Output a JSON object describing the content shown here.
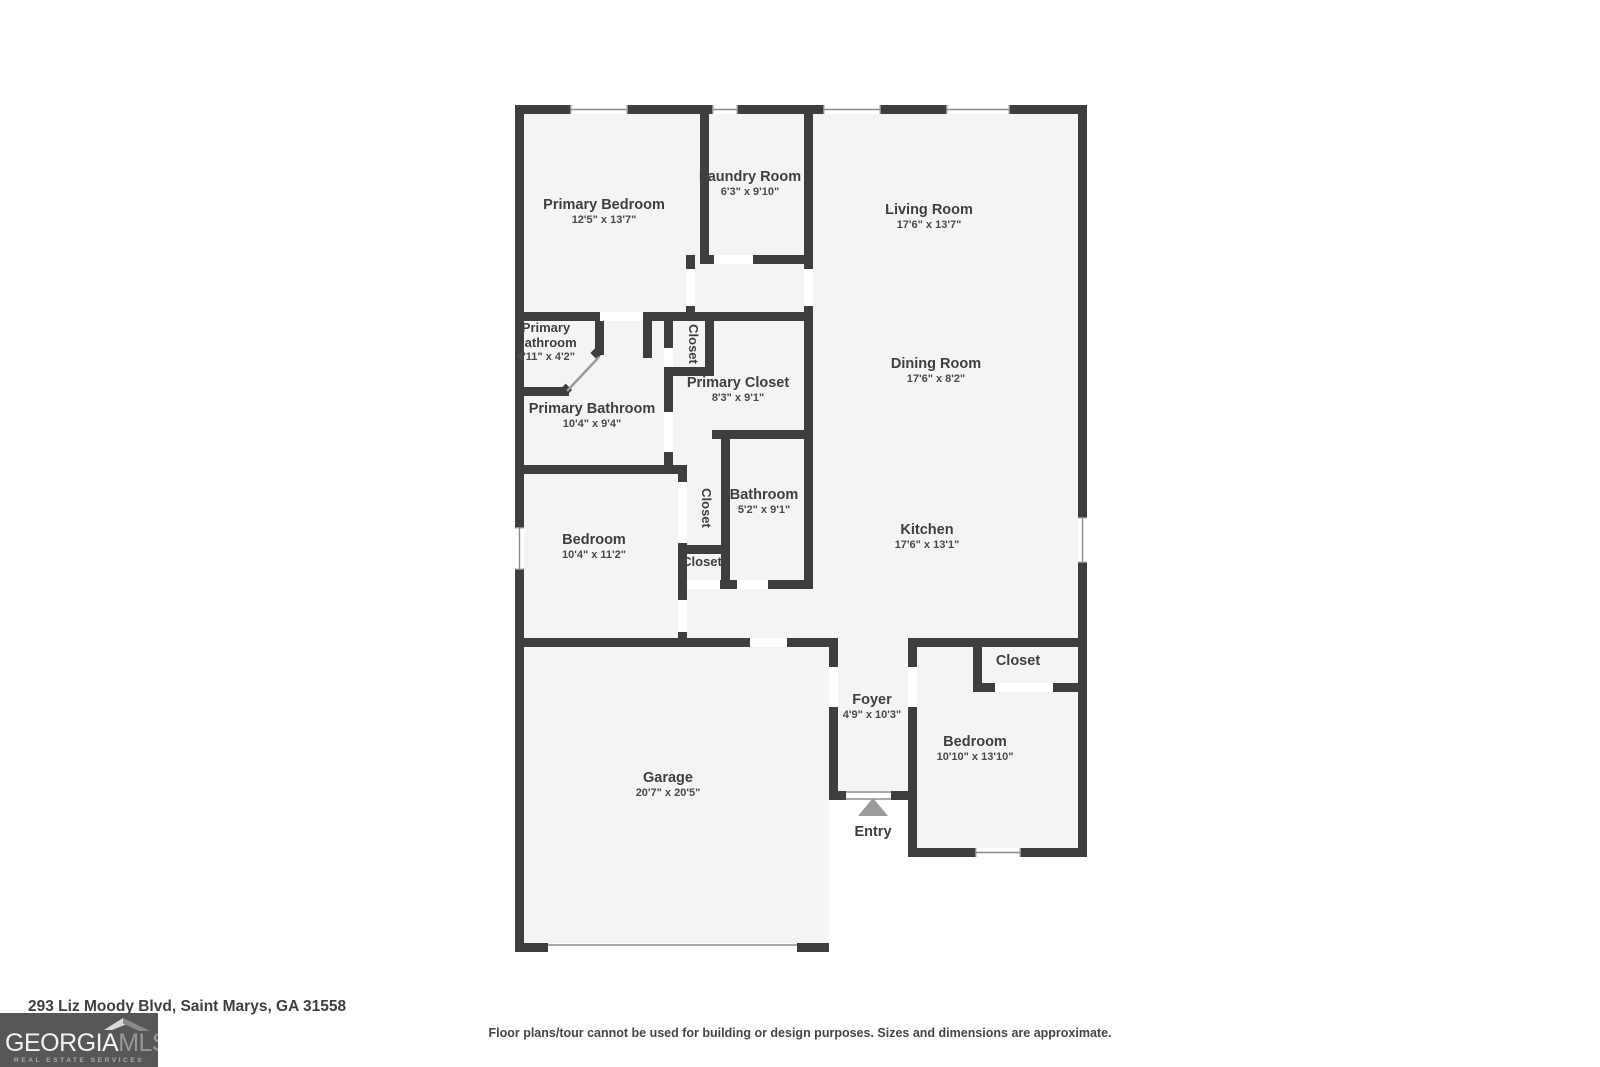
{
  "colors": {
    "wall": "#3e3e40",
    "floor": "#f4f4f4",
    "label": "#3f3f41",
    "logo_background": "#57575a",
    "logo_accent": "#97979a"
  },
  "plan": {
    "entry_label": "Entry",
    "rooms": {
      "primary_bedroom": {
        "name": "Primary Bedroom",
        "dims": "12'5\" x 13'7\""
      },
      "laundry": {
        "name": "Laundry Room",
        "dims": "6'3\" x 9'10\""
      },
      "living": {
        "name": "Living Room",
        "dims": "17'6\" x 13'7\""
      },
      "primary_bathroom_small": {
        "name_line1": "Primary",
        "name_line2": "Bathroom",
        "dims": "4'11\" x 4'2\""
      },
      "closet_top": {
        "name": "Closet"
      },
      "primary_closet": {
        "name": "Primary Closet",
        "dims": "8'3\" x 9'1\""
      },
      "primary_bathroom": {
        "name": "Primary Bathroom",
        "dims": "10'4\" x 9'4\""
      },
      "dining": {
        "name": "Dining Room",
        "dims": "17'6\" x 8'2\""
      },
      "bedroom_left": {
        "name": "Bedroom",
        "dims": "10'4\" x 11'2\""
      },
      "closet_mid": {
        "name": "Closet"
      },
      "bathroom": {
        "name": "Bathroom",
        "dims": "5'2\" x 9'1\""
      },
      "closet_small": {
        "name": "Closet"
      },
      "kitchen": {
        "name": "Kitchen",
        "dims": "17'6\" x 13'1\""
      },
      "garage": {
        "name": "Garage",
        "dims": "20'7\" x 20'5\""
      },
      "foyer": {
        "name": "Foyer",
        "dims": "4'9\" x 10'3\""
      },
      "closet_bedroom2": {
        "name": "Closet"
      },
      "bedroom_right": {
        "name": "Bedroom",
        "dims": "10'10\" x 13'10\""
      }
    }
  },
  "footer": {
    "address": "293 Liz Moody Blvd, Saint Marys, GA 31558",
    "disclaimer": "Floor plans/tour cannot be used for building or design purposes. Sizes and dimensions are approximate.",
    "logo": {
      "word1": "GEORGIA",
      "word2": "MLS",
      "tagline": "REAL ESTATE SERVICES"
    }
  }
}
